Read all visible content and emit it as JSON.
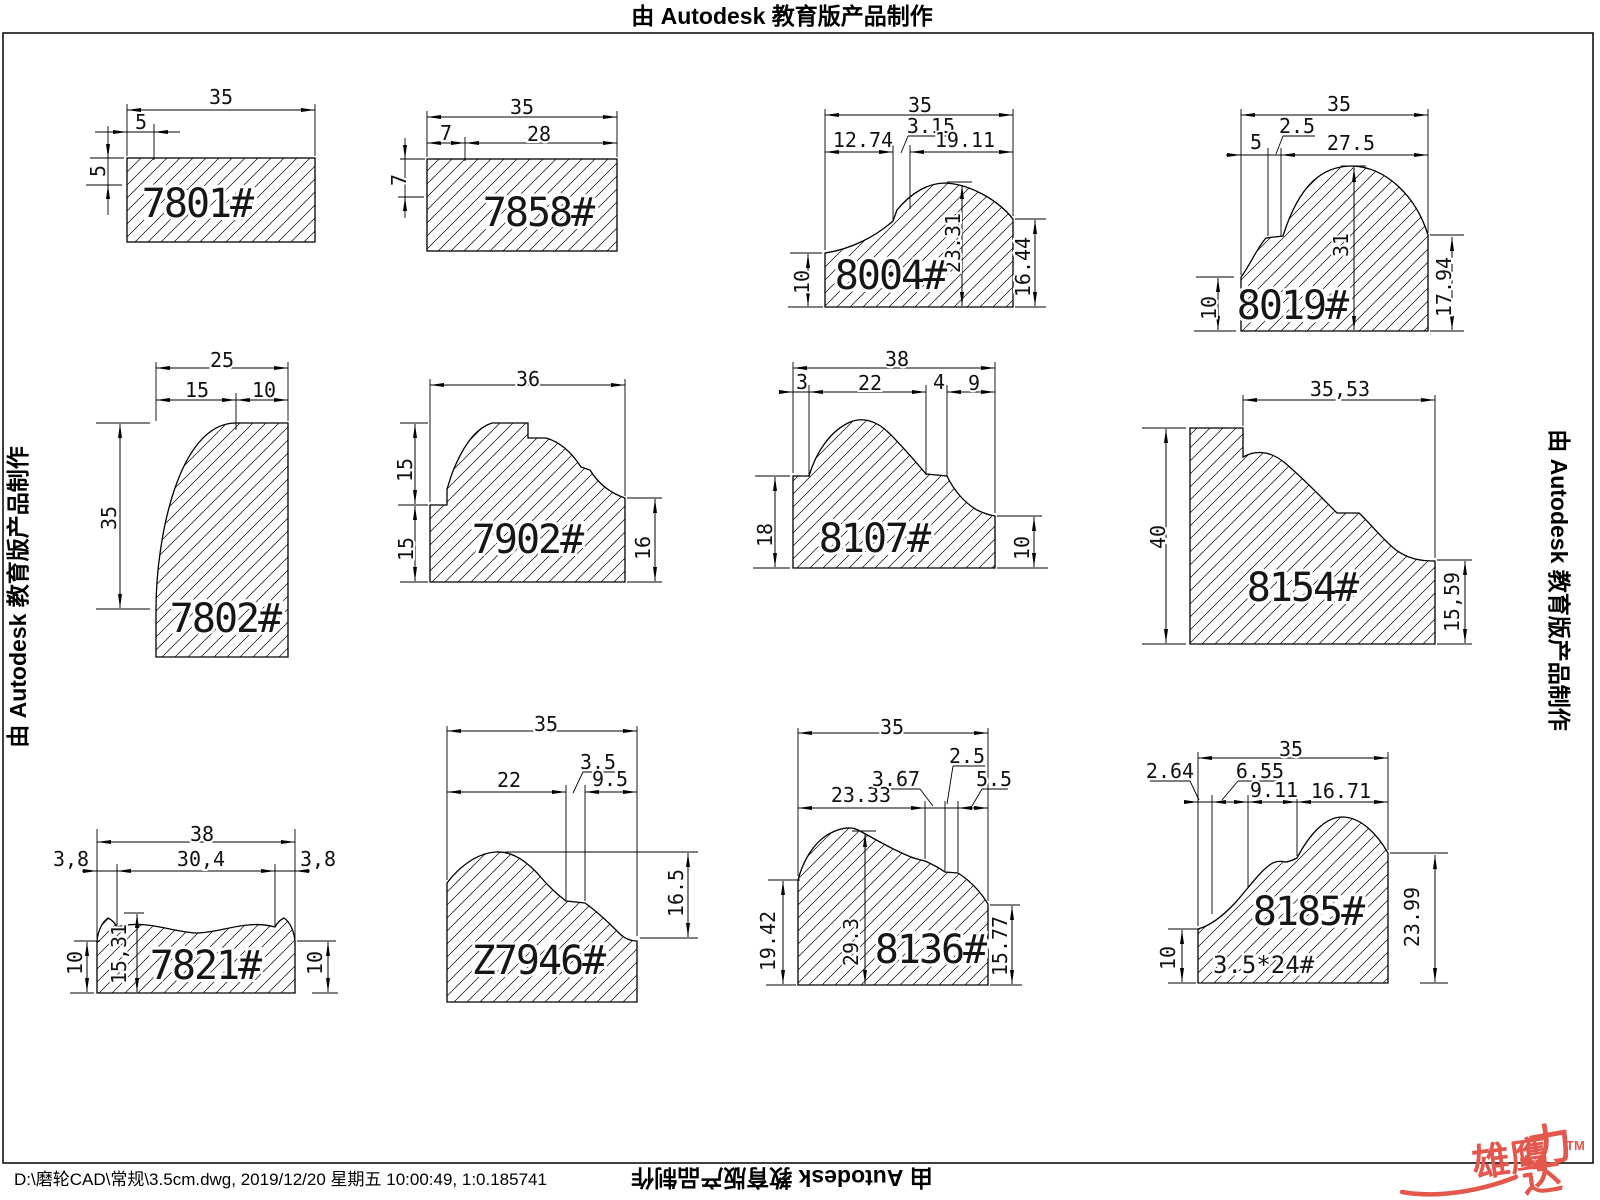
{
  "page": {
    "watermark_top": "由 Autodesk 教育版产品制作",
    "watermark_bottom": "由 Autodesk 教育版产品制作",
    "watermark_left": "由 Autodesk 教育版产品制作",
    "watermark_right": "由 Autodesk 教育版产品制作",
    "footer_path": "D:\\磨轮CAD\\常规\\3.5cm.dwg, 2019/12/20 星期五 10:00:49, 1:0.185741",
    "logo": {
      "text_main": "雄鹰",
      "text_li": "力",
      "text_da": "达",
      "tm": "TM",
      "color": "#e4574d"
    }
  },
  "profiles": [
    {
      "label": "7801#",
      "dims": {
        "w": "35",
        "a": "5",
        "b": "5"
      }
    },
    {
      "label": "7858#",
      "dims": {
        "w": "35",
        "a": "7",
        "b": "28",
        "c": "7"
      }
    },
    {
      "label": "8004#",
      "dims": {
        "w": "35",
        "a": "3.15",
        "b": "12.74",
        "c": "19.11",
        "d": "23.31",
        "e": "16.44",
        "f": "10"
      }
    },
    {
      "label": "8019#",
      "dims": {
        "w": "35",
        "a": "2.5",
        "b": "5",
        "c": "27.5",
        "d": "31",
        "e": "17.94",
        "f": "10"
      }
    },
    {
      "label": "7802#",
      "dims": {
        "w": "25",
        "a": "15",
        "b": "10",
        "c": "35"
      }
    },
    {
      "label": "7902#",
      "dims": {
        "w": "36",
        "a": "15",
        "b": "15",
        "c": "16"
      }
    },
    {
      "label": "8107#",
      "dims": {
        "w": "38",
        "a": "3",
        "b": "22",
        "c": "4",
        "d": "9",
        "e": "18",
        "f": "10"
      }
    },
    {
      "label": "8154#",
      "dims": {
        "w": "35,53",
        "a": "40",
        "b": "15,59"
      }
    },
    {
      "label": "7821#",
      "dims": {
        "w": "38",
        "a": "3,8",
        "b": "30,4",
        "c": "3,8",
        "d": "15,31",
        "e": "10",
        "f": "10"
      }
    },
    {
      "label": "Z7946#",
      "dims": {
        "w": "35",
        "a": "22",
        "b": "3.5",
        "c": "9.5",
        "d": "16.5"
      }
    },
    {
      "label": "8136#",
      "dims": {
        "w": "35",
        "a": "23.33",
        "b": "3.67",
        "c": "2.5",
        "d": "5.5",
        "e": "29.3",
        "f": "19.42",
        "g": "15.77"
      }
    },
    {
      "label": "8185#",
      "dims": {
        "w": "35",
        "a": "2.64",
        "b": "6.55",
        "c": "9.11",
        "d": "16.71",
        "e": "23.99",
        "f": "10"
      },
      "sub_label": "3.5*24#"
    }
  ]
}
